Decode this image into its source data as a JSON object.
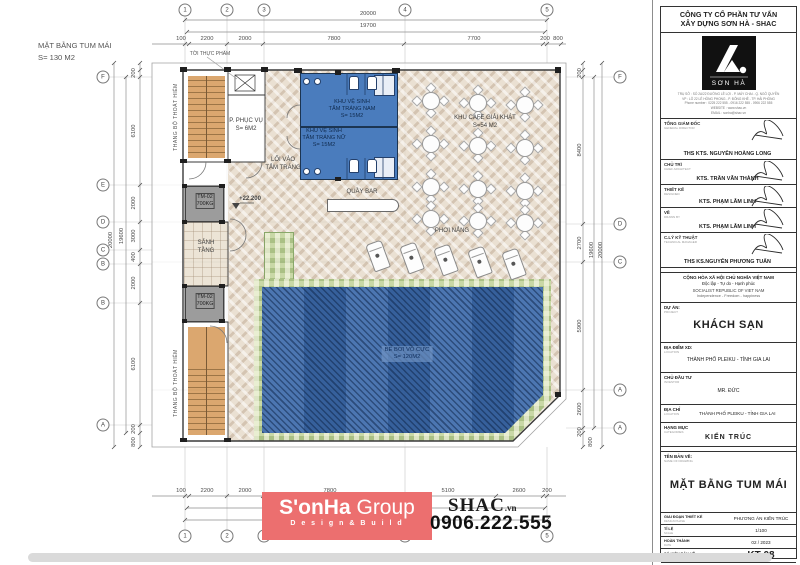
{
  "meta": {
    "title_line1": "MẶT BẰNG TUM MÁI",
    "title_line2": "S= 130 M2"
  },
  "watermark": {
    "brand": "S'onHa",
    "brand2": "Group",
    "tagline": "D e s i g n  &  B u i l d",
    "site": "SHAC",
    "site_tld": ".vn",
    "phone": "0906.222.555",
    "accent": "#ec6f6f"
  },
  "plan": {
    "labels": [
      {
        "t": [
          "TỜI THỰC PHẨM"
        ],
        "x": 210,
        "y": 51,
        "c": "sm",
        "n": "label-food-lift"
      },
      {
        "t": [
          "THANG BỘ THOÁT HIỂM"
        ],
        "x": 176,
        "y": 117,
        "c": "sm",
        "r": 1,
        "n": "label-escape-stair-top"
      },
      {
        "t": [
          "THANG BỘ THOÁT HIỂM"
        ],
        "x": 176,
        "y": 383,
        "c": "sm",
        "r": 1,
        "n": "label-escape-stair-bottom"
      },
      {
        "t": [
          "P. PHỤC VỤ",
          "S= 6M2"
        ],
        "x": 246,
        "y": 118,
        "n": "label-service-room"
      },
      {
        "t": [
          "KHU VỆ SINH",
          "TẮM TRÁNG NAM",
          "S= 15M2"
        ],
        "x": 352,
        "y": 99,
        "c": "blue",
        "n": "label-men-bathroom"
      },
      {
        "t": [
          "KHU VỆ SINH",
          "TẮM TRÁNG NỮ",
          "S= 15M2"
        ],
        "x": 324,
        "y": 128,
        "c": "blue",
        "n": "label-women-bathroom"
      },
      {
        "t": [
          "LỐI VÀO",
          "TẮM TRÁNG"
        ],
        "x": 283,
        "y": 157,
        "n": "label-bath-entry"
      },
      {
        "t": [
          "KHU CAFE GIẢI KHÁT",
          "S=54 M2"
        ],
        "x": 485,
        "y": 115,
        "n": "label-cafe"
      },
      {
        "t": [
          "QUẦY BAR"
        ],
        "x": 362,
        "y": 189,
        "n": "label-bar"
      },
      {
        "t": [
          "TM-02",
          "700KG"
        ],
        "x": 205,
        "y": 193,
        "c": "elev",
        "n": "label-elevator-1"
      },
      {
        "t": [
          "TM-02",
          "700KG"
        ],
        "x": 205,
        "y": 293,
        "c": "elev",
        "n": "label-elevator-2"
      },
      {
        "t": [
          "SẢNH",
          "TẦNG"
        ],
        "x": 206,
        "y": 240,
        "n": "label-lobby"
      },
      {
        "t": [
          "+22.200"
        ],
        "x": 250,
        "y": 196,
        "c": "lvl",
        "n": "label-level-mark"
      },
      {
        "t": [
          "PHƠI NẮNG"
        ],
        "x": 452,
        "y": 228,
        "n": "label-sunbathing"
      },
      {
        "t": [
          "BỂ BƠI VÔ CỰC",
          "S= 120M2"
        ],
        "x": 407,
        "y": 346,
        "c": "pool",
        "n": "label-pool"
      }
    ],
    "dims": [
      {
        "t": "20000",
        "x": 368,
        "y": 14
      },
      {
        "t": "19700",
        "x": 368,
        "y": 26
      },
      {
        "t": "100",
        "x": 181,
        "y": 39
      },
      {
        "t": "2200",
        "x": 207,
        "y": 39
      },
      {
        "t": "2000",
        "x": 245,
        "y": 39
      },
      {
        "t": "7800",
        "x": 334,
        "y": 39
      },
      {
        "t": "7700",
        "x": 474,
        "y": 39
      },
      {
        "t": "200",
        "x": 545,
        "y": 39
      },
      {
        "t": "800",
        "x": 558,
        "y": 39
      },
      {
        "t": "100",
        "x": 181,
        "y": 491
      },
      {
        "t": "2200",
        "x": 207,
        "y": 491
      },
      {
        "t": "2000",
        "x": 245,
        "y": 491
      },
      {
        "t": "7800",
        "x": 330,
        "y": 491
      },
      {
        "t": "5100",
        "x": 448,
        "y": 491
      },
      {
        "t": "2600",
        "x": 519,
        "y": 491
      },
      {
        "t": "200",
        "x": 547,
        "y": 491
      },
      {
        "t": "19700",
        "x": 365,
        "y": 504
      },
      {
        "t": "20000",
        "x": 368,
        "y": 516
      },
      {
        "t": "200",
        "x": 134,
        "y": 73,
        "r": 1
      },
      {
        "t": "6100",
        "x": 134,
        "y": 131,
        "r": 1
      },
      {
        "t": "2000",
        "x": 134,
        "y": 203,
        "r": 1
      },
      {
        "t": "3000",
        "x": 134,
        "y": 236,
        "r": 1
      },
      {
        "t": "400",
        "x": 134,
        "y": 257,
        "r": 1
      },
      {
        "t": "2000",
        "x": 134,
        "y": 283,
        "r": 1
      },
      {
        "t": "6100",
        "x": 134,
        "y": 364,
        "r": 1
      },
      {
        "t": "200",
        "x": 134,
        "y": 429,
        "r": 1
      },
      {
        "t": "800",
        "x": 134,
        "y": 442,
        "r": 1
      },
      {
        "t": "19600",
        "x": 122,
        "y": 236,
        "r": 1
      },
      {
        "t": "20000",
        "x": 111,
        "y": 240,
        "r": 1
      },
      {
        "t": "200",
        "x": 580,
        "y": 73,
        "r": 1
      },
      {
        "t": "8400",
        "x": 580,
        "y": 150,
        "r": 1
      },
      {
        "t": "2700",
        "x": 580,
        "y": 243,
        "r": 1
      },
      {
        "t": "5900",
        "x": 580,
        "y": 326,
        "r": 1
      },
      {
        "t": "2600",
        "x": 580,
        "y": 409,
        "r": 1
      },
      {
        "t": "200",
        "x": 580,
        "y": 432,
        "r": 1
      },
      {
        "t": "800",
        "x": 591,
        "y": 442,
        "r": 1
      },
      {
        "t": "19600",
        "x": 592,
        "y": 250,
        "r": 1
      },
      {
        "t": "20000",
        "x": 601,
        "y": 250,
        "r": 1
      }
    ],
    "bubbles": [
      {
        "t": "1",
        "x": 185,
        "y": 10
      },
      {
        "t": "2",
        "x": 227,
        "y": 10
      },
      {
        "t": "3",
        "x": 264,
        "y": 10
      },
      {
        "t": "4",
        "x": 405,
        "y": 10
      },
      {
        "t": "5",
        "x": 547,
        "y": 10
      },
      {
        "t": "1",
        "x": 185,
        "y": 536
      },
      {
        "t": "2",
        "x": 227,
        "y": 536
      },
      {
        "t": "3",
        "x": 264,
        "y": 536
      },
      {
        "t": "4",
        "x": 405,
        "y": 536
      },
      {
        "t": "5",
        "x": 547,
        "y": 536
      },
      {
        "t": "F",
        "x": 103,
        "y": 77
      },
      {
        "t": "E",
        "x": 103,
        "y": 185
      },
      {
        "t": "D",
        "x": 103,
        "y": 222
      },
      {
        "t": "C",
        "x": 103,
        "y": 250
      },
      {
        "t": "B",
        "x": 103,
        "y": 264
      },
      {
        "t": "B",
        "x": 103,
        "y": 303
      },
      {
        "t": "A",
        "x": 103,
        "y": 425
      },
      {
        "t": "F",
        "x": 620,
        "y": 77
      },
      {
        "t": "D",
        "x": 620,
        "y": 224
      },
      {
        "t": "C",
        "x": 620,
        "y": 262
      },
      {
        "t": "A",
        "x": 620,
        "y": 390
      },
      {
        "t": "A",
        "x": 620,
        "y": 428
      }
    ],
    "cafe_tables": [
      [
        430,
        100
      ],
      [
        477,
        102
      ],
      [
        524,
        104
      ],
      [
        430,
        143
      ],
      [
        477,
        145
      ],
      [
        524,
        147
      ],
      [
        430,
        186
      ],
      [
        477,
        188
      ],
      [
        524,
        190
      ],
      [
        430,
        218
      ],
      [
        477,
        220
      ],
      [
        524,
        222
      ]
    ],
    "loungers": [
      [
        378,
        256
      ],
      [
        412,
        258
      ],
      [
        446,
        260
      ],
      [
        480,
        262
      ],
      [
        514,
        264
      ]
    ]
  },
  "titleblock": {
    "company": [
      "CÔNG TY CỔ PHẦN TƯ VẤN",
      "XÂY DỰNG SƠN HÀ - SHAC"
    ],
    "logo_name": "SƠN HÀ",
    "address": [
      "TRỤ SỞ : SỐ 2A/22 ĐƯỜNG LÊ LỢI - P. MÁY CHAI - Q. NGÔ QUYỀN",
      "VP : LÔ 22 LÊ HỒNG PHONG - P. ĐÔNG KHÊ - TP. HẢI PHÒNG",
      "Phone number : 0225 222 555 - 0916 222 555 - 0906 222 555",
      "WEBSITE : www.shac.vn",
      "EMAIL : sonha@shac.vn"
    ],
    "signatures": [
      {
        "label": "TỔNG GIÁM ĐỐC",
        "sub": "GENERAL DIRECTOR",
        "name": "THS KTS. NGUYỄN HOÀNG LONG"
      },
      {
        "label": "CHỦ TRÌ",
        "sub": "CHIEF ARCHITECT",
        "name": "KTS. TRẦN VĂN THÀNH"
      },
      {
        "label": "THIẾT KẾ",
        "sub": "DESIGNED",
        "name": "KTS. PHẠM LÂM LINH"
      },
      {
        "label": "VẼ",
        "sub": "DRAWN BY",
        "name": "KTS. PHẠM LÂM LINH"
      },
      {
        "label": "C.LÝ KỸ THUẬT",
        "sub": "TECHNICAL MANAGER",
        "name": "THS KS.NGUYỄN PHƯƠNG TUẤN"
      }
    ],
    "republic": [
      "CỘNG HÒA XÃ HỘI CHỦ NGHĨA VIỆT NAM",
      "Độc lập - Tự do - Hạnh phúc",
      "SOCIALIST REPUBLIC OF VIET NAM",
      "Independence - Freedom - happiness"
    ],
    "fields": [
      {
        "label": "DỰ ÁN:",
        "sub": "PROJECT",
        "value": "KHÁCH SẠN"
      },
      {
        "label": "ĐỊA ĐIỂM XD:",
        "sub": "LOCATION",
        "value": "THÀNH PHỐ PLEIKU - TỈNH GIA LAI"
      },
      {
        "label": "CHỦ ĐẦU TƯ",
        "sub": "INVESTOR",
        "value": "MR. ĐỨC"
      },
      {
        "label": "ĐỊA CHỈ",
        "sub": "LOCATION",
        "value": "THÀNH PHỐ PLEIKU - TỈNH GIA LAI"
      },
      {
        "label": "HẠNG MỤC",
        "sub": "CATEGORIES",
        "value": "KIẾN TRÚC"
      },
      {
        "label": "TÊN BẢN VẼ:",
        "sub": "NAME OF DRAWING",
        "value": "MẶT BẰNG TUM MÁI"
      }
    ],
    "footer": [
      {
        "label": "GIAI ĐOẠN THIẾT KẾ",
        "sub": "DESIGN PHASE",
        "value": "PHƯƠNG ÁN KIẾN TRÚC"
      },
      {
        "label": "TỈ LỆ",
        "sub": "SCALE",
        "value": "1/100"
      },
      {
        "label": "HOÀN THÀNH",
        "sub": "DATE",
        "value": "02 / 2023"
      },
      {
        "label": "SỐ HIỆU BẢN VẼ",
        "sub": "TITLE OF DRAWING",
        "value": "KT-08"
      }
    ]
  }
}
